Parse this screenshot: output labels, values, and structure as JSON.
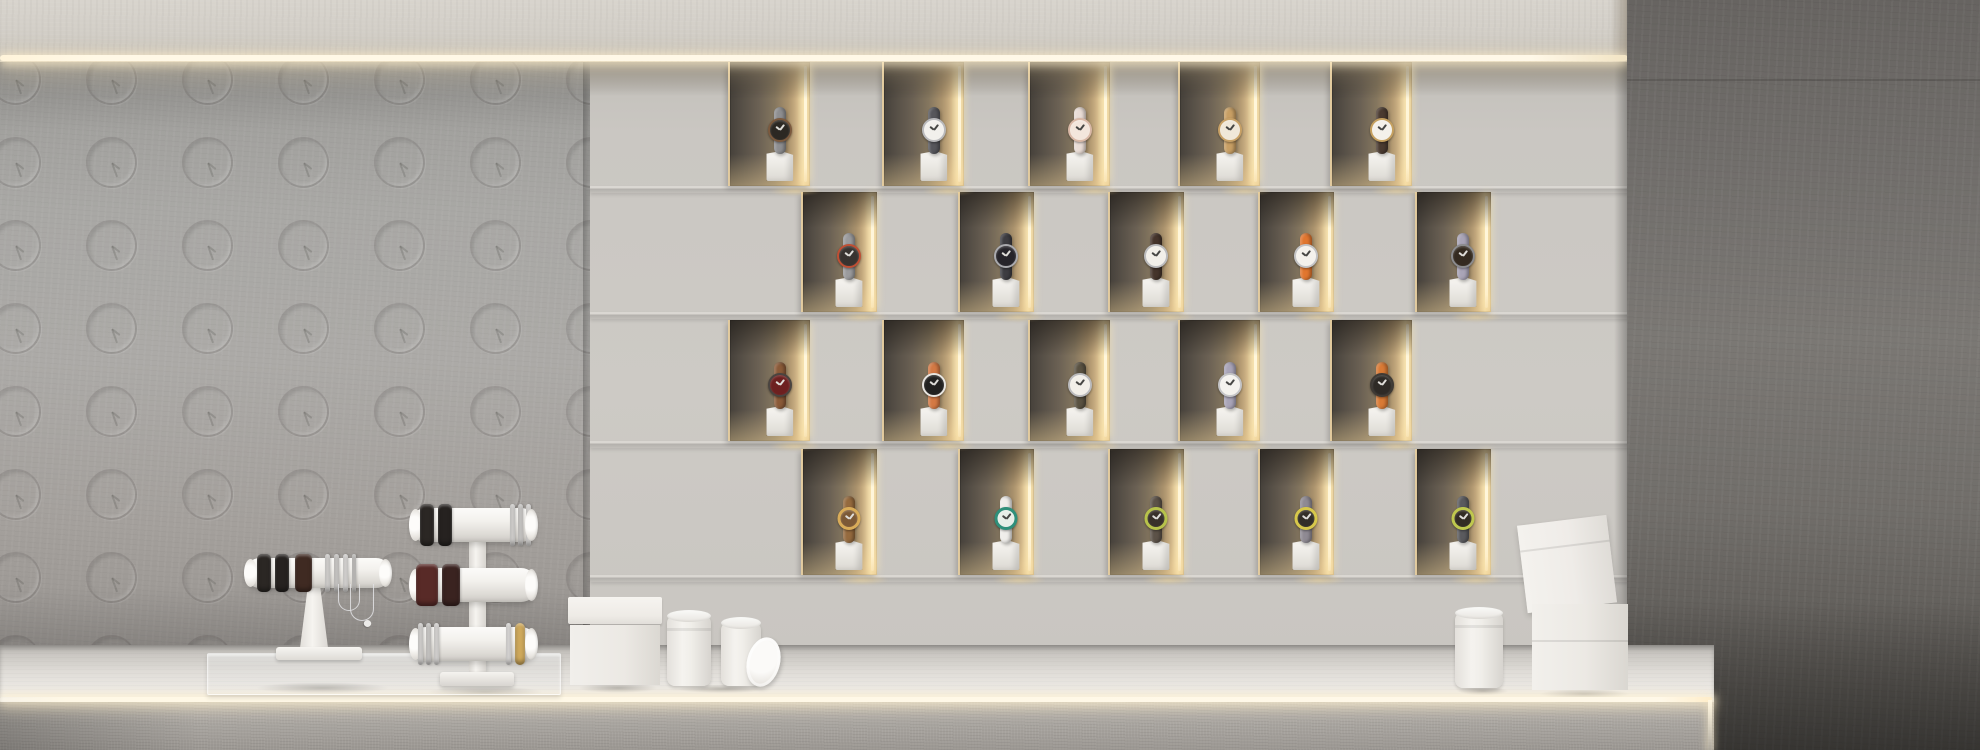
{
  "scene": {
    "description": "Photorealistic 3D render of a minimalist watch boutique: concrete side wall embossed with a grid of clock icons, a backlit display wall of staggered niches each holding one watch on a small white pedestal, warm LED strips under the ceiling bulkhead and along the counter edge, and a white counter with bracelet T-bar stands, an acrylic base, gift boxes and round canisters",
    "visible_text": "none"
  },
  "palette": {
    "bulkhead": "#d2cec7",
    "led_warm": "#fff6e0",
    "left_wall": "#a8a7a4",
    "display_panel": "#c9c6c1",
    "niche_dark": "#564f47",
    "niche_bronze": "#93815f",
    "niche_gold": "#ecd6a4",
    "counter_top": "#ebe8e4",
    "counter_face": "#aba7a2",
    "right_wall": "#716e6b",
    "prop_white": "#f2f0ed",
    "silver": "#dedcda",
    "gold": "#cfa95c"
  },
  "left_wall": {
    "pattern": "embossed-clock-icons",
    "clock_time_hint": "hands around 4-5 o'clock",
    "grid": {
      "x0": -10,
      "y0": 54,
      "dx": 96,
      "dy": 83,
      "cols": 7,
      "rows": 8,
      "d": 47
    }
  },
  "display_wall": {
    "x": 590,
    "width": 1040,
    "shelf_lines_y": [
      186,
      312,
      441,
      575
    ],
    "rows": [
      {
        "y": 62,
        "h": 124,
        "w": 80,
        "xs": [
          728,
          882,
          1028,
          1178,
          1330
        ],
        "watches": [
          {
            "desc": "black dial, bronze bezel, grey steel strap",
            "dial": "#2c2823",
            "case": "#7c5a3e",
            "strap": "#8e8e90",
            "hands": "light"
          },
          {
            "desc": "white dial, slate grey strap",
            "dial": "#f2f0ec",
            "case": "#b9b9bb",
            "strap": "#56565b",
            "hands": "dark"
          },
          {
            "desc": "blush dial, pale pink strap, rose-gold case",
            "dial": "#f3e6dc",
            "case": "#d9b8a6",
            "strap": "#e9dcd5",
            "hands": "dark"
          },
          {
            "desc": "cream dial, tan gold strap",
            "dial": "#f0e8d9",
            "case": "#c8a166",
            "strap": "#c89f64",
            "hands": "dark"
          },
          {
            "desc": "white dial, dark brown strap, gold case",
            "dial": "#f4f1ea",
            "case": "#c5a05f",
            "strap": "#4a3a30",
            "hands": "dark"
          }
        ]
      },
      {
        "y": 192,
        "h": 120,
        "w": 74,
        "xs": [
          801,
          958,
          1108,
          1258,
          1415
        ],
        "watches": [
          {
            "desc": "dark dial, red-orange bezel, grey strap",
            "dial": "#383330",
            "case": "#bf4f34",
            "strap": "#9b9b9d",
            "hands": "light"
          },
          {
            "desc": "black dial, charcoal strap",
            "dial": "#26242a",
            "case": "#a9a9ad",
            "strap": "#3d3c41",
            "hands": "light"
          },
          {
            "desc": "white dial, dark brown strap",
            "dial": "#f2efe9",
            "case": "#bbbbbd",
            "strap": "#45342b",
            "hands": "dark"
          },
          {
            "desc": "white dial, orange strap",
            "dial": "#f4f1ec",
            "case": "#c3c3c5",
            "strap": "#e1762f",
            "hands": "dark"
          },
          {
            "desc": "dark brown dial, lilac grey strap",
            "dial": "#342a20",
            "case": "#8b8b8d",
            "strap": "#a9a4b7",
            "hands": "light"
          }
        ]
      },
      {
        "y": 320,
        "h": 121,
        "w": 80,
        "xs": [
          728,
          882,
          1028,
          1178,
          1330
        ],
        "watches": [
          {
            "desc": "burgundy dial, walnut brown strap",
            "dial": "#6d2020",
            "case": "#4a4440",
            "strap": "#8a5a38",
            "hands": "light"
          },
          {
            "desc": "black dial, amber strap, white case",
            "dial": "#222120",
            "case": "#e8e5e0",
            "strap": "#d47944",
            "hands": "light"
          },
          {
            "desc": "white dial, olive bronze strap",
            "dial": "#f2efe9",
            "case": "#bbbbbd",
            "strap": "#5a5242",
            "hands": "dark"
          },
          {
            "desc": "white dial, lavender strap",
            "dial": "#f4f2ee",
            "case": "#c4c4c6",
            "strap": "#a9a4b8",
            "hands": "dark"
          },
          {
            "desc": "black dial, bright orange strap",
            "dial": "#2e2a26",
            "case": "#3f3a35",
            "strap": "#d97a35",
            "hands": "light"
          }
        ]
      },
      {
        "y": 449,
        "h": 126,
        "w": 74,
        "xs": [
          801,
          958,
          1108,
          1258,
          1415
        ],
        "watches": [
          {
            "desc": "gold open-ring bezel, walnut wood strap",
            "dial": "#7c5936",
            "case": "#d9ac59",
            "strap": "#956a3e",
            "hands": "light",
            "ring": true
          },
          {
            "desc": "skeleton dial, teal ring, white strap",
            "dial": "#e8eee8",
            "case": "#2f8f7a",
            "strap": "#efedea",
            "hands": "dark",
            "ring": true
          },
          {
            "desc": "dark dial, chartreuse ring, taupe strap",
            "dial": "#38302a",
            "case": "#b7c24b",
            "strap": "#5c5248",
            "hands": "light",
            "ring": true
          },
          {
            "desc": "dark dial, yellow ring, grey strap",
            "dial": "#332e28",
            "case": "#d7c74b",
            "strap": "#8f8a93",
            "hands": "light",
            "ring": true
          },
          {
            "desc": "dark dial, chartreuse ring, charcoal strap",
            "dial": "#322c24",
            "case": "#bfc84e",
            "strap": "#5a5a5e",
            "hands": "light",
            "ring": true
          }
        ]
      }
    ]
  },
  "counter": {
    "stands": [
      {
        "name": "single-tier bracelet stand on acrylic base",
        "bars": [
          {
            "bracelets": [
              {
                "x": 12,
                "w": 14,
                "c": "#2b2724"
              },
              {
                "x": 30,
                "w": 14,
                "c": "#262220"
              },
              {
                "x": 50,
                "w": 17,
                "c": "#3f2a22"
              },
              {
                "x": 80,
                "w": 5,
                "c": "#dedcda"
              },
              {
                "x": 89,
                "w": 5,
                "c": "#d4d2d0"
              },
              {
                "x": 98,
                "w": 5,
                "c": "#e2e0de"
              },
              {
                "x": 107,
                "w": 4,
                "c": "#d0cecb"
              }
            ]
          }
        ]
      },
      {
        "name": "three-tier bracelet stand",
        "bars": [
          {
            "bracelets": [
              {
                "x": 10,
                "w": 14,
                "c": "#2b2724"
              },
              {
                "x": 28,
                "w": 14,
                "c": "#262220"
              },
              {
                "x": 100,
                "w": 5,
                "c": "#dedcda"
              },
              {
                "x": 108,
                "w": 5,
                "c": "#d4d2d0"
              },
              {
                "x": 116,
                "w": 5,
                "c": "#e2e0de"
              }
            ]
          },
          {
            "bracelets": [
              {
                "x": 6,
                "w": 22,
                "c": "#582a27"
              },
              {
                "x": 32,
                "w": 18,
                "c": "#3a2320"
              }
            ]
          },
          {
            "bracelets": [
              {
                "x": 8,
                "w": 5,
                "c": "#dedcda"
              },
              {
                "x": 16,
                "w": 5,
                "c": "#d4d2d0"
              },
              {
                "x": 24,
                "w": 5,
                "c": "#e2e0de"
              },
              {
                "x": 96,
                "w": 5,
                "c": "#e6e4e2"
              },
              {
                "x": 105,
                "w": 10,
                "c": "#cfa95c"
              }
            ]
          }
        ]
      }
    ],
    "props": [
      "white gift box with lid",
      "two white round canisters with a leaning round lid",
      "white round canister (right)",
      "two stacked white gift boxes (top one tilted)"
    ]
  }
}
